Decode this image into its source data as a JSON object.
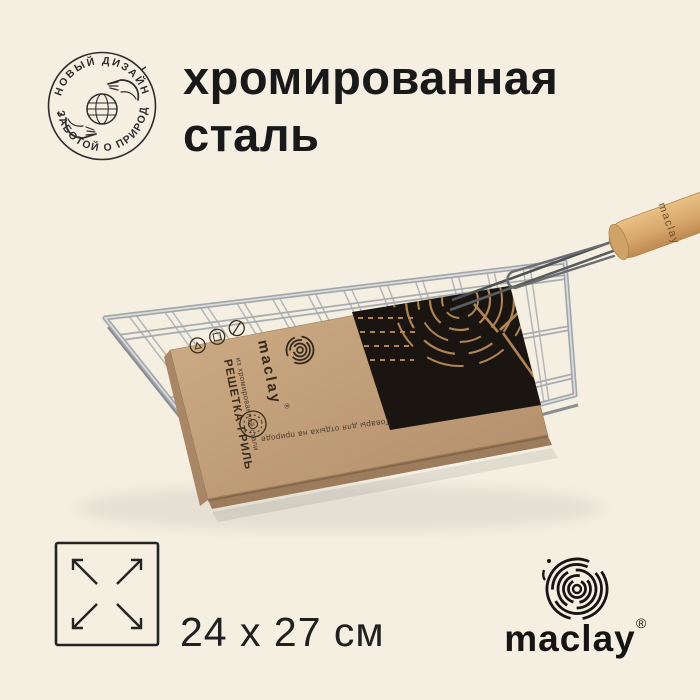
{
  "page": {
    "background_color": "#f5efe2",
    "ink_color": "#1c1c1c"
  },
  "badge": {
    "top_text": "НОВЫЙ ДИЗАЙН",
    "bottom_text": "С ЗАБОТОЙ О ПРИРОДЕ"
  },
  "title": {
    "line1": "хромированная",
    "line2": "сталь"
  },
  "product": {
    "sleeve": {
      "brand": "maclay",
      "reg": "®",
      "name": "РЕШЕТКА-ГРИЛЬ",
      "subtitle": "из хромированной стали",
      "tagline": "Товары для отдыха на природе",
      "kraft_color": "#bf9c77",
      "print_color": "#1a1510"
    },
    "handle": {
      "brand": "maclay",
      "wood_color": "#d8a76c"
    },
    "steel_color": "#a9adb0"
  },
  "size_label": {
    "text": "24 x 27 см"
  },
  "brand_logo": {
    "name": "maclay",
    "reg": "®",
    "color": "#171513"
  }
}
